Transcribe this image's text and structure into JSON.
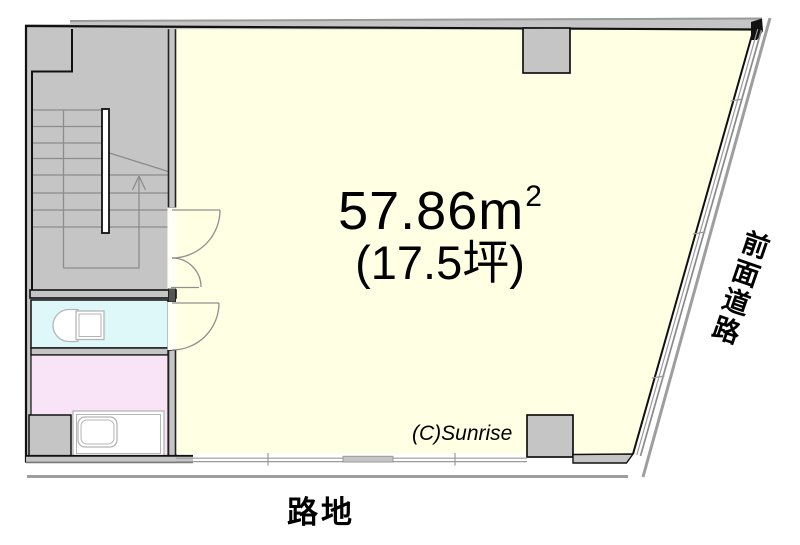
{
  "labels": {
    "area_value": "57.86m",
    "area_sup": "2",
    "area_tsubo": "(17.5坪)",
    "copyright": "(C)Sunrise",
    "alley": "路地",
    "front_road": "前面道路"
  },
  "colors": {
    "wall": "#C5C5C5",
    "main_room": "#FFFFE4",
    "toilet_room": "#DEF7F8",
    "bath_room": "#F9E3F7",
    "outline": "#111111",
    "road_line": "#9E9E9E",
    "stair_line": "#8C8C8C",
    "text": "#000000"
  }
}
